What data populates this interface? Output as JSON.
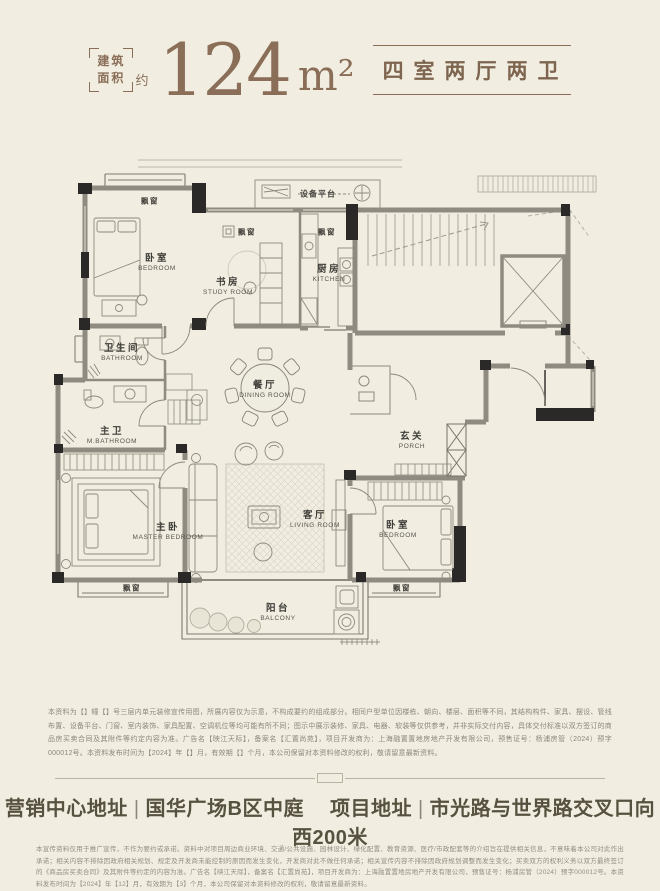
{
  "header": {
    "area_box": [
      "建筑",
      "面积"
    ],
    "approx_label": "约",
    "area_value": "124",
    "area_unit": "m²",
    "layout_type": "四室两厅两卫"
  },
  "floorplan": {
    "bay_window_label": "飘窗",
    "equipment_platform_label": "设备平台",
    "rooms": {
      "bedroom_top": {
        "zh": "卧室",
        "en": "BEDROOM"
      },
      "study": {
        "zh": "书房",
        "en": "STUDY ROOM"
      },
      "kitchen": {
        "zh": "厨房",
        "en": "KITCHEN"
      },
      "bathroom": {
        "zh": "卫生间",
        "en": "BATHROOM"
      },
      "master_bathroom": {
        "zh": "主卫",
        "en": "M.BATHROOM"
      },
      "dining": {
        "zh": "餐厅",
        "en": "DINING ROOM"
      },
      "porch": {
        "zh": "玄关",
        "en": "PORCH"
      },
      "master_bedroom": {
        "zh": "主卧",
        "en": "MASTER BEDROOM"
      },
      "living": {
        "zh": "客厅",
        "en": "LIVING ROOM"
      },
      "bedroom_bottom": {
        "zh": "卧室",
        "en": "BEDROOM"
      },
      "balcony": {
        "zh": "阳台",
        "en": "BALCONY"
      }
    }
  },
  "plan_disclaimer": "本资料为【】幢【】号三层内单元装修宣传用图，所展内容仅为示意，不构成要约的组成部分。相同户型单位因楼栋、朝向、楼层、面积等不同，其结构构件、家具、摆设、管线布置、设备平台、门窗、室内装饰、家具配置、空调机位等均可能有所不同；图示中展示装修、家具、电器、软装等仅供参考，并非实际交付内容，具体交付标准以双方签订的商品房买卖合同及其附件等约定内容为准。广告名【映江天际】，备案名【汇置尚苑】，项目开发商为：上海融置置地房地产开发有限公司，预售证号：杨浦房管（2024）预字000012号。本资料发布时间为【2024】年【】月，有效期【】个月，本公司保留对本资料修改的权利，敬请留意最新资料。",
  "footer": {
    "marketing_center_label": "营销中心地址",
    "marketing_center_value": "国华广场B区中庭",
    "project_label": "项目地址",
    "project_value": "市光路与世界路交叉口向西200米",
    "separator": "|",
    "fine_print": "本宣传资料仅用于推广宣传，不作为要约或承诺。资料中对项目周边商业环境、交通/公共设施、园林设计、绿化配置、教育资源、医疗/市政配套等的介绍旨在提供相关信息，不意味着本公司对此作出承诺；相关内容不排除因政府相关规划、规定及开发商未能控制的原因而发生变化，开发商对此不做任何承诺；相关宣传内容不排除因政府规划调整而发生变化；买卖双方的权利义务以双方最终签订的《商品房买卖合同》及其附件等约定的内容为准。广告名【映江天际】，备案名【汇置尚苑】，项目开发商为：上海融置置地房地产开发有限公司，预售证号：杨浦房管（2024）预字000012号。本资料发布时间为【2024】年【12】月，有效期为【3】个月，本公司保留对本资料修改的权利，敬请留意最新资料。"
  },
  "colors": {
    "background": "#f1eee1",
    "accent_brown": "#8a6e58",
    "wall_dark": "#2b2927",
    "wall_gray": "#8f8b81"
  }
}
